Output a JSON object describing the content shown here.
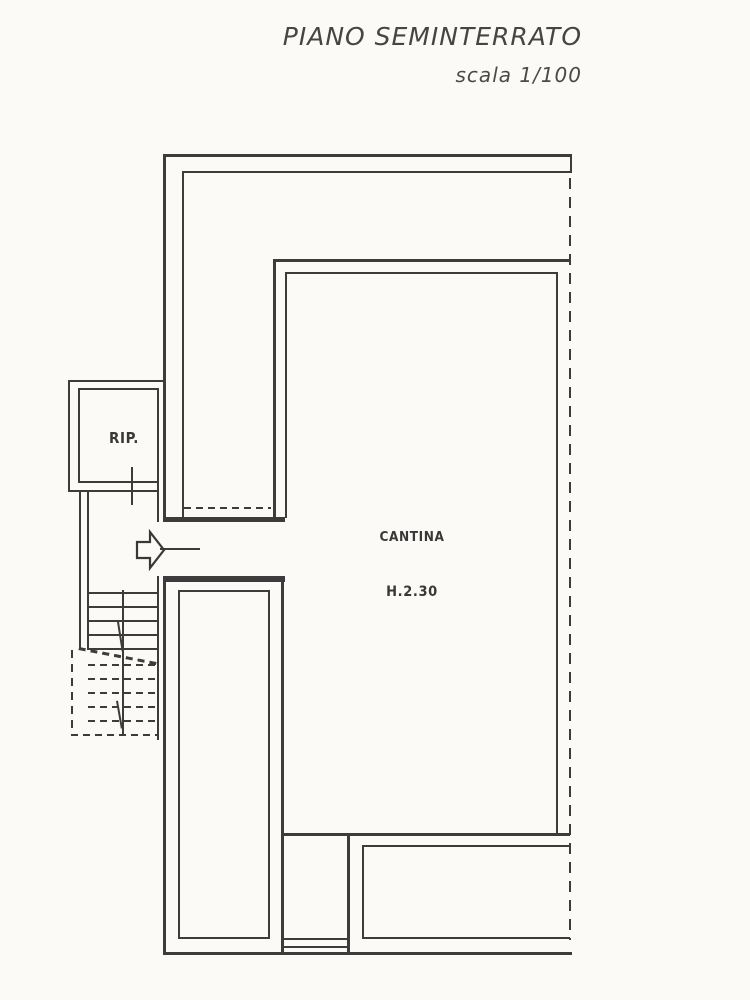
{
  "title": {
    "main": "PIANO SEMINTERRATO",
    "scale": "scala 1/100"
  },
  "rooms": {
    "rip": {
      "label": "RIP."
    },
    "cantina": {
      "label": "CANTINA",
      "height": "H.2.30"
    }
  },
  "icons": {
    "entrance_arrow": "block-arrow-right"
  },
  "colors": {
    "ink": "#3c3c3c",
    "paper": "#fbfaf7"
  }
}
